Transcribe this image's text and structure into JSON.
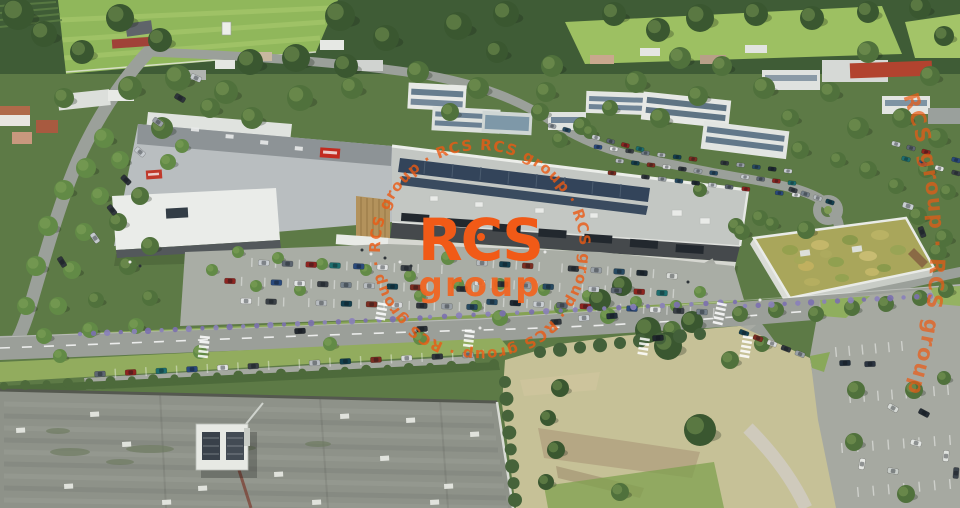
{
  "image": {
    "kind": "aerial-architectural-rendering",
    "subject": "retail-park-with-parking-offices-fields-and-warehouse-roof"
  },
  "watermark": {
    "brand_color": "#F15A17",
    "logo_line1": "RCS",
    "logo_line2": "group",
    "ring_text": "RCS group · RCS group · RCS group · RCS group · RCS group · RCS group · ",
    "arc_text": "RCS group · RCS group · RCS group"
  },
  "scene": {
    "palette": {
      "brand_orange": "#F15A17",
      "field_green": "#90B75B",
      "forest_green": "#3F5C36",
      "asphalt": "#A9ADA5",
      "road": "#9B9F99",
      "roof_gray": "#C3C7C3",
      "solar_panel": "#33445A",
      "green_roof": "#A9A65B",
      "warehouse_roof": "#8E9289",
      "lavender": "#7B6FB0",
      "sign_red": "#C22B20"
    },
    "car_colors": [
      "#1f2a33",
      "#c9ced2",
      "#5d6671",
      "#8e2420",
      "#1e6e6e",
      "#2a4a7c",
      "#e2e4e4",
      "#3a4046",
      "#74808a",
      "#b7bcc0",
      "#143f4e",
      "#7c2e22",
      "#d9dbdc",
      "#30363c",
      "#9aa1a7",
      "#274a62"
    ],
    "trees": [
      [
        18,
        14,
        16,
        0
      ],
      [
        44,
        34,
        13,
        0
      ],
      [
        82,
        52,
        12,
        0
      ],
      [
        120,
        18,
        14,
        0
      ],
      [
        160,
        40,
        12,
        0
      ],
      [
        250,
        62,
        13,
        0
      ],
      [
        296,
        58,
        14,
        0
      ],
      [
        340,
        16,
        15,
        0
      ],
      [
        386,
        38,
        13,
        0
      ],
      [
        346,
        66,
        12,
        0
      ],
      [
        458,
        26,
        14,
        0
      ],
      [
        506,
        14,
        13,
        0
      ],
      [
        497,
        52,
        11,
        0
      ],
      [
        552,
        66,
        11,
        1
      ],
      [
        614,
        14,
        12,
        0
      ],
      [
        658,
        30,
        12,
        0
      ],
      [
        700,
        18,
        14,
        0
      ],
      [
        756,
        14,
        12,
        0
      ],
      [
        812,
        18,
        12,
        0
      ],
      [
        868,
        12,
        11,
        0
      ],
      [
        920,
        8,
        11,
        0
      ],
      [
        944,
        36,
        10,
        0
      ],
      [
        868,
        52,
        11,
        1
      ],
      [
        680,
        58,
        11,
        1
      ],
      [
        722,
        66,
        10,
        1
      ],
      [
        178,
        78,
        13,
        1
      ],
      [
        226,
        92,
        12,
        1
      ],
      [
        130,
        88,
        12,
        1
      ],
      [
        64,
        98,
        10,
        1
      ],
      [
        418,
        72,
        11,
        1
      ],
      [
        478,
        88,
        11,
        1
      ],
      [
        546,
        92,
        10,
        1
      ],
      [
        636,
        82,
        11,
        1
      ],
      [
        698,
        96,
        10,
        1
      ],
      [
        764,
        88,
        11,
        1
      ],
      [
        300,
        98,
        13,
        1
      ],
      [
        352,
        88,
        11,
        1
      ],
      [
        930,
        76,
        10,
        1
      ],
      [
        830,
        92,
        10,
        1
      ],
      [
        902,
        118,
        10,
        1
      ],
      [
        858,
        128,
        11,
        1
      ],
      [
        938,
        138,
        10,
        1
      ],
      [
        790,
        118,
        9,
        1
      ],
      [
        660,
        118,
        10,
        1
      ],
      [
        582,
        126,
        9,
        1
      ],
      [
        540,
        112,
        9,
        1
      ],
      [
        610,
        108,
        8,
        1
      ],
      [
        450,
        112,
        9,
        1
      ],
      [
        252,
        118,
        11,
        1
      ],
      [
        210,
        108,
        10,
        1
      ],
      [
        162,
        128,
        11,
        1
      ],
      [
        104,
        138,
        10,
        2
      ],
      [
        86,
        168,
        10,
        2
      ],
      [
        120,
        160,
        9,
        2
      ],
      [
        64,
        190,
        10,
        2
      ],
      [
        100,
        196,
        9,
        2
      ],
      [
        48,
        226,
        10,
        2
      ],
      [
        84,
        232,
        9,
        2
      ],
      [
        36,
        266,
        10,
        2
      ],
      [
        72,
        270,
        9,
        2
      ],
      [
        26,
        306,
        9,
        2
      ],
      [
        58,
        306,
        9,
        2
      ],
      [
        118,
        222,
        9,
        1
      ],
      [
        140,
        196,
        9,
        1
      ],
      [
        150,
        246,
        9,
        1
      ],
      [
        128,
        266,
        9,
        1
      ],
      [
        96,
        300,
        8,
        1
      ],
      [
        150,
        298,
        8,
        1
      ],
      [
        44,
        336,
        8,
        2
      ],
      [
        90,
        330,
        8,
        2
      ],
      [
        136,
        326,
        8,
        2
      ],
      [
        168,
        162,
        8,
        2
      ],
      [
        182,
        146,
        7,
        2
      ],
      [
        560,
        140,
        8,
        1
      ],
      [
        590,
        132,
        7,
        1
      ],
      [
        800,
        150,
        9,
        1
      ],
      [
        838,
        160,
        8,
        1
      ],
      [
        868,
        170,
        9,
        1
      ],
      [
        896,
        186,
        8,
        1
      ],
      [
        926,
        170,
        8,
        1
      ],
      [
        948,
        192,
        8,
        1
      ],
      [
        806,
        230,
        9,
        1
      ],
      [
        760,
        218,
        8,
        1
      ],
      [
        736,
        226,
        8,
        1
      ],
      [
        918,
        216,
        9,
        1
      ],
      [
        944,
        238,
        9,
        1
      ],
      [
        700,
        190,
        7,
        1
      ],
      [
        238,
        252,
        6,
        2
      ],
      [
        278,
        258,
        6,
        2
      ],
      [
        322,
        264,
        6,
        2
      ],
      [
        366,
        270,
        6,
        2
      ],
      [
        300,
        290,
        6,
        2
      ],
      [
        256,
        286,
        6,
        2
      ],
      [
        410,
        276,
        6,
        2
      ],
      [
        448,
        258,
        7,
        2
      ],
      [
        458,
        284,
        6,
        2
      ],
      [
        500,
        284,
        6,
        2
      ],
      [
        544,
        290,
        6,
        2
      ],
      [
        588,
        296,
        6,
        2
      ],
      [
        636,
        302,
        6,
        2
      ],
      [
        560,
        308,
        6,
        2
      ],
      [
        476,
        306,
        6,
        2
      ],
      [
        420,
        296,
        6,
        2
      ],
      [
        676,
        306,
        6,
        2
      ],
      [
        700,
        292,
        6,
        2
      ],
      [
        212,
        270,
        6,
        2
      ],
      [
        500,
        318,
        8,
        2
      ],
      [
        608,
        316,
        8,
        2
      ],
      [
        672,
        330,
        9,
        1
      ],
      [
        740,
        314,
        8,
        1
      ],
      [
        776,
        310,
        8,
        1
      ],
      [
        816,
        314,
        8,
        1
      ],
      [
        852,
        308,
        8,
        1
      ],
      [
        886,
        304,
        8,
        1
      ],
      [
        920,
        298,
        8,
        1
      ],
      [
        946,
        290,
        8,
        1
      ],
      [
        742,
        232,
        8,
        1
      ],
      [
        772,
        224,
        7,
        1
      ],
      [
        938,
        252,
        9,
        1
      ],
      [
        600,
        300,
        11,
        0
      ],
      [
        622,
        286,
        10,
        0
      ],
      [
        648,
        330,
        13,
        0
      ],
      [
        668,
        346,
        14,
        0
      ],
      [
        692,
        322,
        11,
        0
      ],
      [
        700,
        430,
        16,
        0
      ],
      [
        560,
        388,
        9,
        0
      ],
      [
        548,
        418,
        8,
        0
      ],
      [
        556,
        450,
        9,
        0
      ],
      [
        546,
        482,
        8,
        0
      ],
      [
        620,
        492,
        9,
        1
      ],
      [
        730,
        360,
        9,
        1
      ],
      [
        762,
        344,
        8,
        1
      ],
      [
        856,
        390,
        9,
        1
      ],
      [
        914,
        390,
        9,
        1
      ],
      [
        854,
        442,
        9,
        1
      ],
      [
        906,
        494,
        9,
        1
      ],
      [
        944,
        378,
        7,
        1
      ],
      [
        200,
        352,
        7,
        2
      ],
      [
        330,
        344,
        7,
        2
      ],
      [
        420,
        338,
        7,
        2
      ],
      [
        60,
        356,
        7,
        2
      ]
    ],
    "car_rows": [
      {
        "x1": 240,
        "y1": 262,
        "x2": 430,
        "y2": 269,
        "n": 9,
        "st": 1
      },
      {
        "x1": 230,
        "y1": 281,
        "x2": 462,
        "y2": 289,
        "n": 11,
        "st": 1
      },
      {
        "x1": 246,
        "y1": 301,
        "x2": 472,
        "y2": 307,
        "n": 10,
        "st": 1
      },
      {
        "x1": 482,
        "y1": 263,
        "x2": 642,
        "y2": 273,
        "n": 8,
        "st": 1
      },
      {
        "x1": 480,
        "y1": 283,
        "x2": 662,
        "y2": 293,
        "n": 9,
        "st": 1
      },
      {
        "x1": 492,
        "y1": 302,
        "x2": 702,
        "y2": 312,
        "n": 10,
        "st": 1
      },
      {
        "x1": 100,
        "y1": 374,
        "x2": 468,
        "y2": 355,
        "n": 13,
        "st": 1
      },
      {
        "x1": 598,
        "y1": 147,
        "x2": 788,
        "y2": 171,
        "n": 13,
        "s": 0.75
      },
      {
        "x1": 604,
        "y1": 159,
        "x2": 792,
        "y2": 183,
        "n": 13,
        "s": 0.75
      },
      {
        "x1": 612,
        "y1": 173,
        "x2": 796,
        "y2": 195,
        "n": 12,
        "s": 0.75
      },
      {
        "x1": 552,
        "y1": 126,
        "x2": 640,
        "y2": 149,
        "n": 7,
        "s": 0.75
      },
      {
        "x1": 896,
        "y1": 144,
        "x2": 956,
        "y2": 160,
        "n": 5,
        "s": 0.8
      },
      {
        "x1": 906,
        "y1": 159,
        "x2": 956,
        "y2": 173,
        "n": 4,
        "s": 0.8
      },
      {
        "x1": 793,
        "y1": 190,
        "x2": 830,
        "y2": 202,
        "n": 4,
        "s": 0.8
      },
      {
        "x1": 744,
        "y1": 333,
        "x2": 800,
        "y2": 354,
        "n": 5,
        "s": 0.9
      }
    ],
    "stall_rows": [
      {
        "x1": 836,
        "y1": 352,
        "x2": 902,
        "y2": 346,
        "n": 6
      },
      {
        "x1": 850,
        "y1": 398,
        "x2": 948,
        "y2": 390,
        "n": 8
      },
      {
        "x1": 842,
        "y1": 448,
        "x2": 950,
        "y2": 440,
        "n": 8
      },
      {
        "x1": 858,
        "y1": 492,
        "x2": 950,
        "y2": 484,
        "n": 7
      }
    ],
    "road_cars": [
      [
        300,
        331,
        -3,
        "#23292f"
      ],
      [
        422,
        329,
        -3,
        "#2b3138"
      ],
      [
        556,
        322,
        -4,
        "#31373d"
      ],
      [
        584,
        318,
        -4,
        "#cdd2d6"
      ],
      [
        612,
        316,
        -4,
        "#222e3a"
      ],
      [
        658,
        338,
        -4,
        "#1f262c"
      ],
      [
        908,
        206,
        18,
        "#c9ced2"
      ],
      [
        922,
        232,
        70,
        "#2e343a"
      ],
      [
        95,
        238,
        55,
        "#c4c9cd"
      ],
      [
        62,
        262,
        58,
        "#2f353b"
      ],
      [
        112,
        210,
        52,
        "#31373d"
      ],
      [
        140,
        152,
        40,
        "#c6cbcf"
      ],
      [
        126,
        180,
        45,
        "#2c3238"
      ],
      [
        158,
        122,
        35,
        "#9aa0a6"
      ],
      [
        180,
        98,
        30,
        "#2e343a"
      ],
      [
        196,
        78,
        25,
        "#c5cacd"
      ],
      [
        672,
        276,
        4,
        "#d9dcd8"
      ],
      [
        845,
        363,
        -2,
        "#23303d"
      ],
      [
        870,
        364,
        -2,
        "#2b3440"
      ],
      [
        893,
        408,
        30,
        "#d6dad6"
      ],
      [
        924,
        413,
        28,
        "#242c34"
      ],
      [
        916,
        443,
        15,
        "#e2e5e2"
      ],
      [
        862,
        464,
        100,
        "#e6e8e4"
      ],
      [
        946,
        456,
        95,
        "#dfe2de"
      ],
      [
        956,
        473,
        95,
        "#3c444c"
      ],
      [
        893,
        471,
        10,
        "#c9ceca"
      ]
    ],
    "skylights": [
      [
        16,
        428
      ],
      [
        64,
        484
      ],
      [
        198,
        486
      ],
      [
        340,
        414
      ],
      [
        406,
        418
      ],
      [
        444,
        484
      ],
      [
        274,
        472
      ],
      [
        122,
        442
      ],
      [
        162,
        500
      ],
      [
        380,
        456
      ],
      [
        312,
        500
      ],
      [
        470,
        432
      ],
      [
        90,
        412
      ],
      [
        430,
        500
      ]
    ],
    "lavender_rows": [
      {
        "x1": 80,
        "y1": 334,
        "x2": 420,
        "y2": 318,
        "n": 26
      },
      {
        "x1": 430,
        "y1": 317,
        "x2": 735,
        "y2": 302,
        "n": 22
      },
      {
        "x1": 745,
        "y1": 306,
        "x2": 930,
        "y2": 296,
        "n": 15
      }
    ],
    "bush_rows": [
      {
        "x1": 505,
        "y1": 382,
        "x2": 515,
        "y2": 500,
        "n": 8,
        "c": "#46633a",
        "r": 6
      },
      {
        "x1": 540,
        "y1": 352,
        "x2": 700,
        "y2": 334,
        "n": 9,
        "c": "#43603a",
        "r": 6
      },
      {
        "x1": 4,
        "y1": 386,
        "x2": 494,
        "y2": 364,
        "n": 24,
        "c": "#4d6a3b",
        "r": 4
      }
    ],
    "crosswalks": [
      {
        "x": 205,
        "y": 336,
        "a": 96,
        "n": 5
      },
      {
        "x": 722,
        "y": 303,
        "a": 102,
        "n": 5
      },
      {
        "x": 748,
        "y": 336,
        "a": 100,
        "n": 5
      },
      {
        "x": 470,
        "y": 330,
        "a": 97,
        "n": 4
      },
      {
        "x": 383,
        "y": 303,
        "a": 100,
        "n": 4
      },
      {
        "x": 645,
        "y": 338,
        "a": 99,
        "n": 4
      }
    ],
    "people": [
      [
        362,
        250
      ],
      [
        371,
        254
      ],
      [
        385,
        258
      ],
      [
        400,
        262
      ],
      [
        411,
        266
      ],
      [
        545,
        252
      ],
      [
        688,
        282
      ],
      [
        130,
        262
      ],
      [
        140,
        266
      ],
      [
        480,
        328
      ],
      [
        415,
        333
      ],
      [
        760,
        300
      ]
    ]
  }
}
